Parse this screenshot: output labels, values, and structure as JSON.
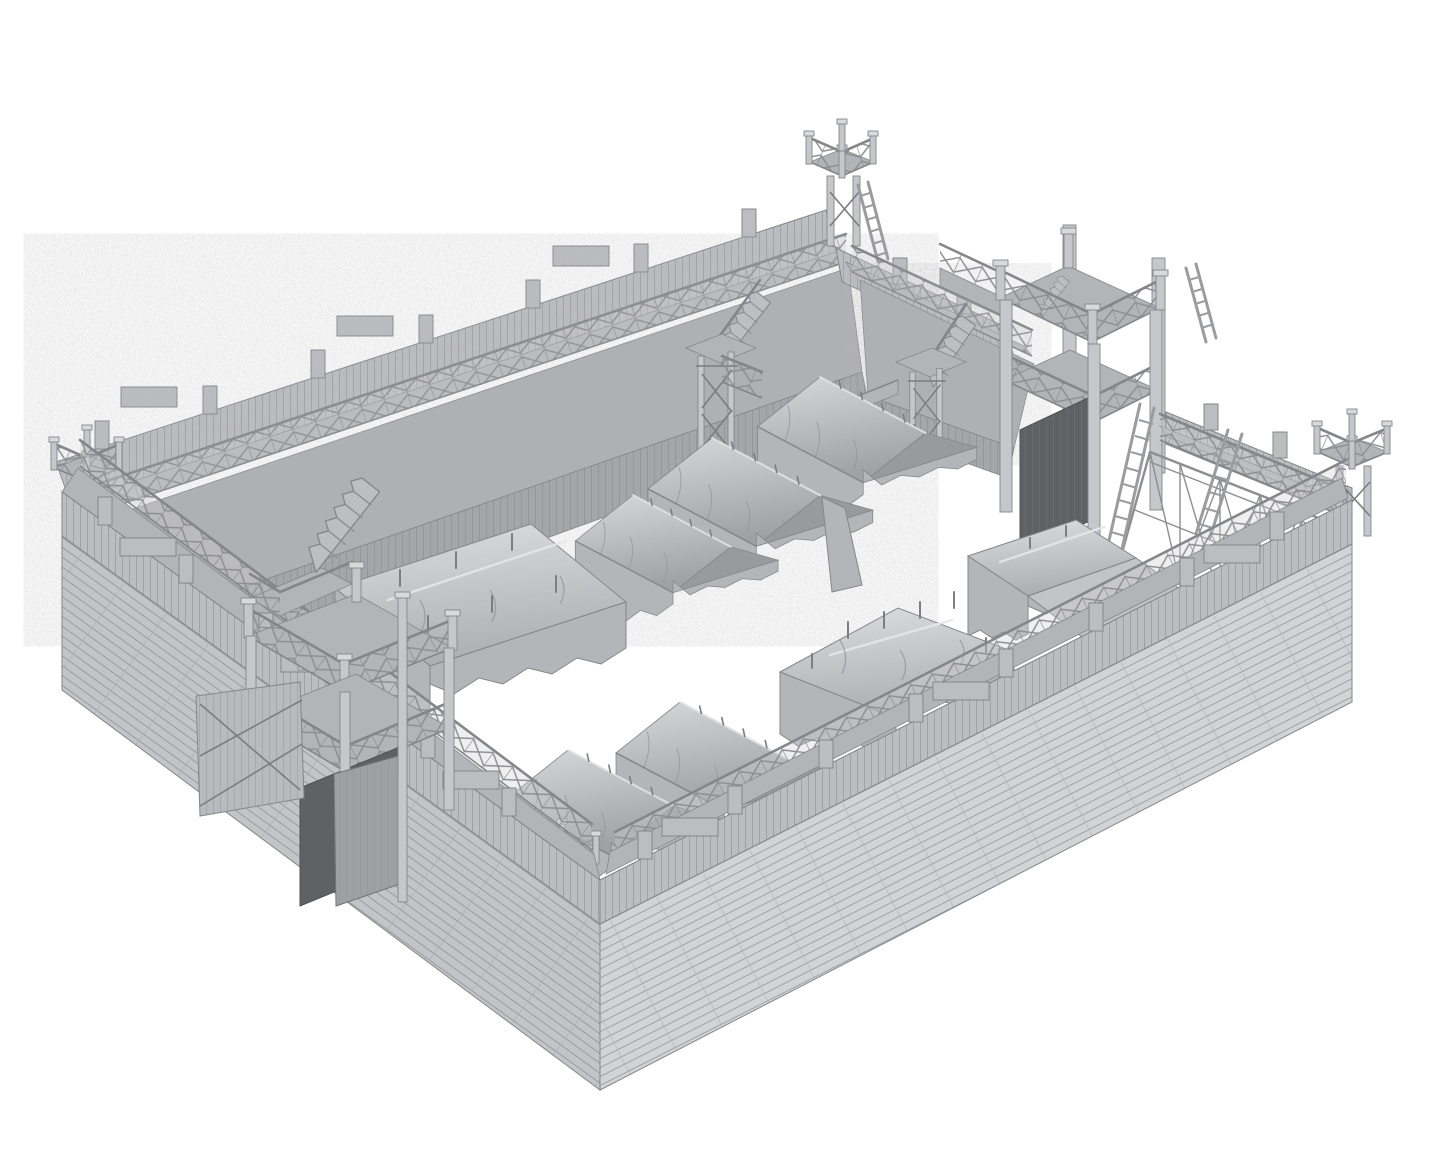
{
  "scene": {
    "title": "Wooden palisade fortress — gray 3D model render",
    "description": "Monochrome gray 3D render on a white background showing a rectangular wooden fortress viewed from above at an angle: plank outer walls topped by a walkway with cross-braced railings and crenellated parapet tabs, four small corner watchtowers, a tall two-storey gatehouse on the upper-right wall, a smaller two-storey gate with open wooden doors on the lower-left wall, earthen ramparts and vertical-log palisades inside the far walls, an open timber truss rampart with leaning ladders on the right wall, three staircases descending into the courtyard, and eight draped canvas tents arranged on the white courtyard floor."
  },
  "objects": {
    "walls": [
      "northwest-wall",
      "northeast-wall",
      "southwest-wall",
      "southeast-wall"
    ],
    "corner_towers": [
      "north-corner-tower",
      "east-corner-tower",
      "south-corner-tower",
      "west-corner-tower"
    ],
    "gates": [
      "northeast-gatehouse",
      "west-gatehouse"
    ],
    "tent_counts": {
      "a_frame_tents": 5,
      "marquee_tents": 2,
      "awning_tents": 1
    },
    "stair_count": 3,
    "ladder_count": 4
  },
  "colors": {
    "background": "#ffffff",
    "line": "#85868a",
    "wall_sw": "#c3c4c8",
    "wall_se": "#d2d3d6",
    "parapet_band": "#bcbdc1",
    "deck": "#b3b4b8",
    "railing_fill": "#d0d1d4",
    "rampart": "#aeafb3",
    "palisade": "#a5a6aa",
    "post": "#c6c7ca",
    "tent_front": "#b4b5b8",
    "tent_gable": "#989a9d",
    "opening": "#606165",
    "truss": "#8d8e92"
  }
}
